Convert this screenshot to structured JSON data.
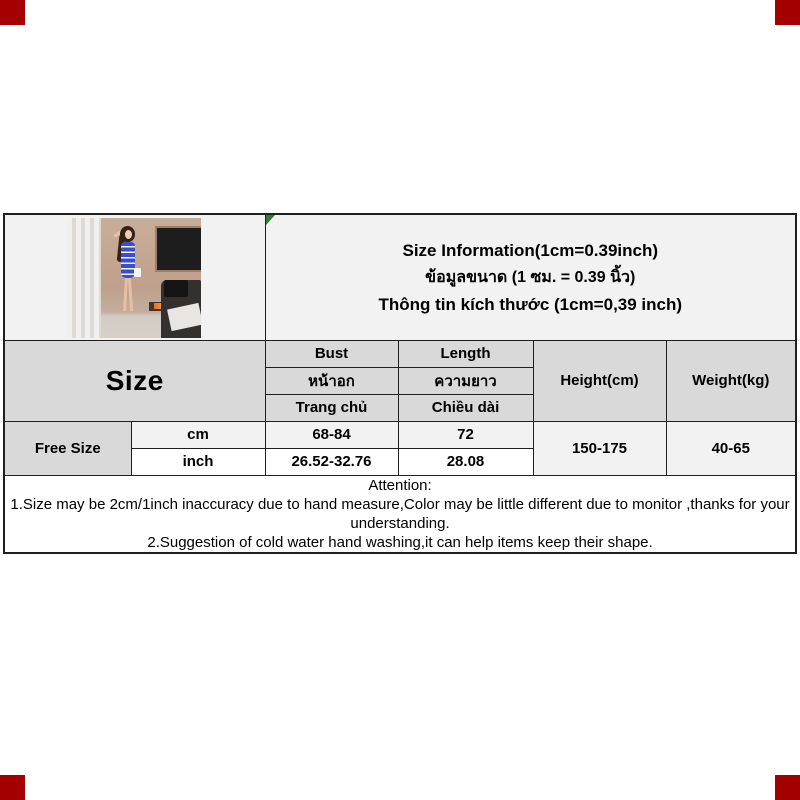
{
  "page": {
    "corner_marker_color": "#a40000"
  },
  "info_header": {
    "line_en": "Size Information(1cm=0.39inch)",
    "line_th": "ข้อมูลขนาด (1 ซม. = 0.39 นิ้ว)",
    "line_vi": "Thông tin kích thước (1cm=0,39 inch)"
  },
  "size_table": {
    "size_header": "Size",
    "bust_header": [
      "Bust",
      "หน้าอก",
      "Trang chủ"
    ],
    "length_header": [
      "Length",
      "ความยาว",
      "Chiều dài"
    ],
    "height_header": "Height(cm)",
    "weight_header": "Weight(kg)",
    "size_value": "Free Size",
    "unit_cm": "cm",
    "unit_inch": "inch",
    "bust_cm": "68-84",
    "bust_inch": "26.52-32.76",
    "length_cm": "72",
    "length_inch": "28.08",
    "height_value": "150-175",
    "weight_value": "40-65"
  },
  "attention": {
    "title": "Attention:",
    "note1": "1.Size may be 2cm/1inch inaccuracy due to hand measure,Color may be little different due to monitor ,thanks for your understanding.",
    "note2": "2.Suggestion of cold water hand washing,it can help items keep their shape."
  }
}
